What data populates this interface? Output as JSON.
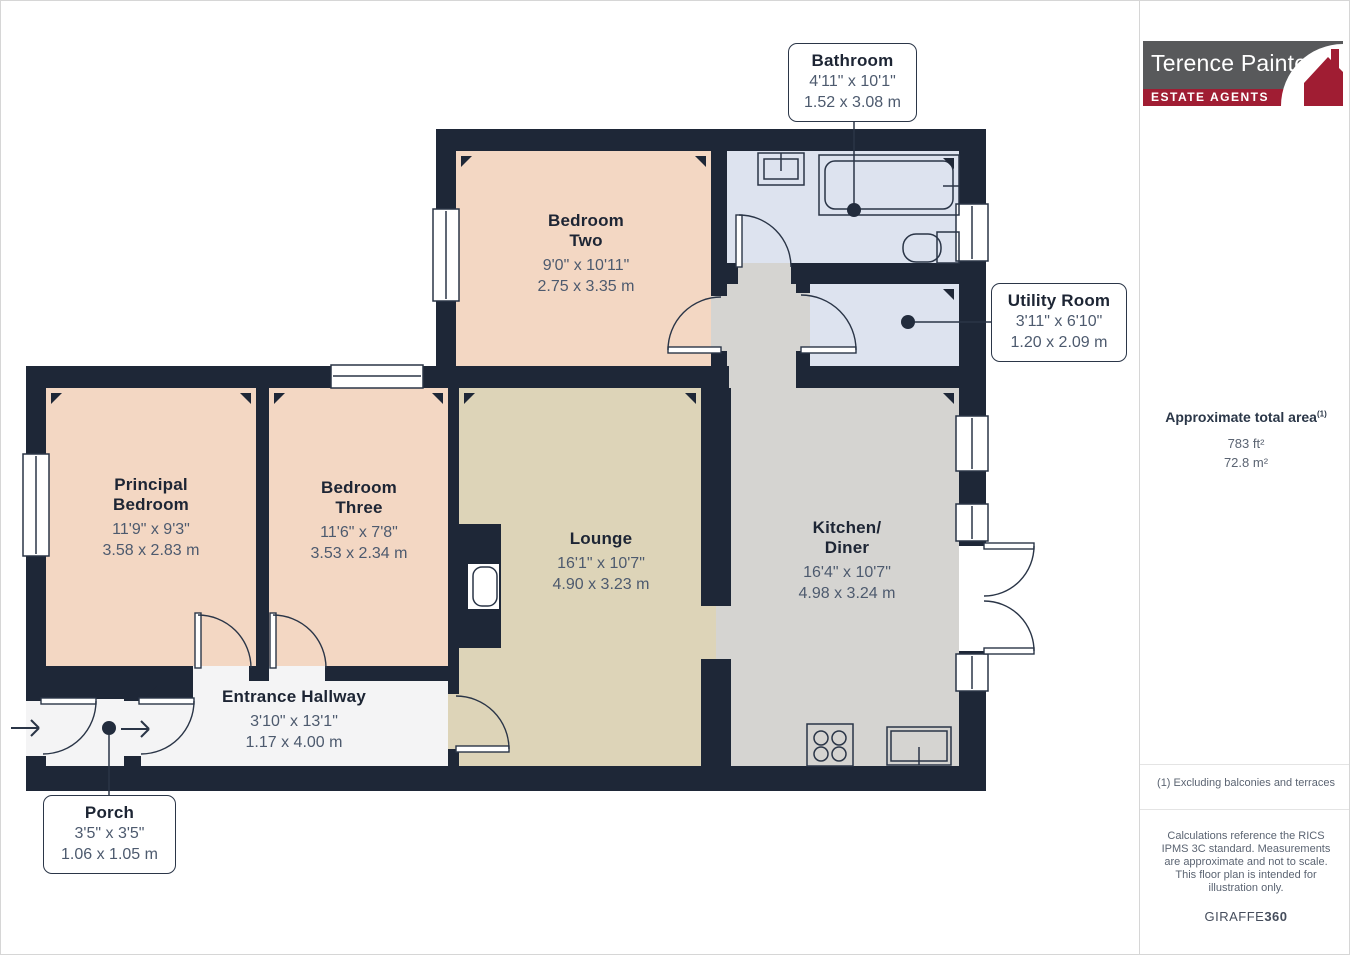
{
  "branding": {
    "agency_name": "Terence Painter",
    "agency_tagline": "ESTATE AGENTS"
  },
  "sidebar": {
    "area_title": "Approximate total area",
    "area_footnote_marker": "(1)",
    "area_imperial": "783 ft²",
    "area_metric": "72.8 m²",
    "footnote": "(1) Excluding balconies and terraces",
    "disclaimer": "Calculations reference the RICS IPMS 3C standard. Measurements are approximate and not to scale. This floor plan is intended for illustration only.",
    "brand_regular": "GIRAFFE",
    "brand_bold": "360"
  },
  "rooms": [
    {
      "id": "bedroom-two",
      "name1": "Bedroom",
      "name2": "Two",
      "imperial": "9'0\" x 10'11\"",
      "metric": "2.75 x 3.35 m"
    },
    {
      "id": "bathroom",
      "name1": "Bathroom",
      "name2": "",
      "imperial": "4'11\" x 10'1\"",
      "metric": "1.52 x 3.08 m"
    },
    {
      "id": "utility-room",
      "name1": "Utility Room",
      "name2": "",
      "imperial": "3'11\" x 6'10\"",
      "metric": "1.20 x 2.09 m"
    },
    {
      "id": "principal-bedroom",
      "name1": "Principal",
      "name2": "Bedroom",
      "imperial": "11'9\" x 9'3\"",
      "metric": "3.58 x 2.83 m"
    },
    {
      "id": "bedroom-three",
      "name1": "Bedroom",
      "name2": "Three",
      "imperial": "11'6\" x 7'8\"",
      "metric": "3.53 x 2.34 m"
    },
    {
      "id": "lounge",
      "name1": "Lounge",
      "name2": "",
      "imperial": "16'1\" x 10'7\"",
      "metric": "4.90 x 3.23 m"
    },
    {
      "id": "kitchen-diner",
      "name1": "Kitchen/",
      "name2": "Diner",
      "imperial": "16'4\" x 10'7\"",
      "metric": "4.98 x 3.24 m"
    },
    {
      "id": "entrance-hallway",
      "name1": "Entrance Hallway",
      "name2": "",
      "imperial": "3'10\" x 13'1\"",
      "metric": "1.17 x 4.00 m"
    },
    {
      "id": "porch",
      "name1": "Porch",
      "name2": "",
      "imperial": "3'5\" x 3'5\"",
      "metric": "1.06 x 1.05 m"
    }
  ],
  "colors": {
    "wall": "#1E2737",
    "bedroom_fill": "#F3D7C3",
    "bathroom_fill": "#DDE3EF",
    "lounge_fill": "#DDD4B8",
    "kitchen_fill": "#D5D4D1",
    "hallway_fill": "#F4F4F5",
    "label_text": "#1D2534",
    "dimension_text": "#4D5A6E",
    "logo_gray": "#58595B",
    "logo_red": "#A01D33"
  }
}
